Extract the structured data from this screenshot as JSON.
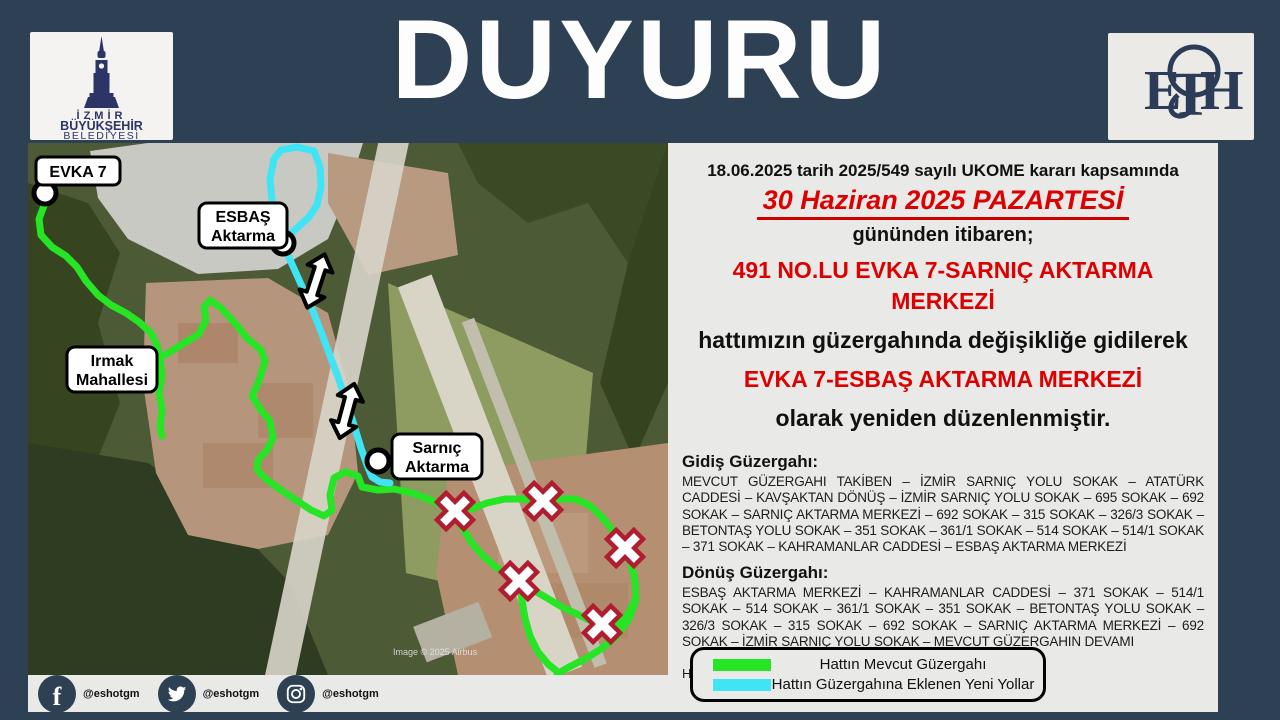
{
  "page": {
    "title": "DUYURU"
  },
  "logos": {
    "izmir": {
      "line1": "İZMİR",
      "line2": "BÜYÜKŞEHİR",
      "line3": "BELEDİYESİ"
    },
    "eshot_letters": [
      "E",
      "T",
      "H"
    ]
  },
  "announcement": {
    "line1": "18.06.2025 tarih 2025/549 sayılı UKOME kararı kapsamında",
    "date_line": "30 Haziran 2025 PAZARTESİ",
    "line3": "gününden itibaren;",
    "route_old": "491 NO.LU EVKA 7-SARNIÇ AKTARMA MERKEZİ",
    "line5": "hattımızın güzergahında değişikliğe gidilerek",
    "route_new": "EVKA 7-ESBAŞ AKTARMA MERKEZİ",
    "line7": "olarak yeniden düzenlenmiştir."
  },
  "gidis": {
    "heading": "Gidiş Güzergahı:",
    "body": "MEVCUT GÜZERGAHI TAKİBEN – İZMİR SARNIÇ YOLU SOKAK – ATATÜRK CADDESİ – KAVŞAKTAN DÖNÜŞ – İZMİR SARNIÇ YOLU SOKAK – 695 SOKAK – 692 SOKAK – SARNIÇ AKTARMA MERKEZİ – 692 SOKAK – 315 SOKAK – 326/3 SOKAK – BETONTAŞ YOLU SOKAK – 351 SOKAK – 361/1 SOKAK – 514 SOKAK – 514/1 SOKAK – 371 SOKAK – KAHRAMANLAR CADDESİ – ESBAŞ AKTARMA MERKEZİ"
  },
  "donus": {
    "heading": "Dönüş Güzergahı:",
    "body": "ESBAŞ AKTARMA MERKEZİ – KAHRAMANLAR CADDESİ – 371 SOKAK – 514/1 SOKAK – 514 SOKAK – 361/1 SOKAK – 351 SOKAK – BETONTAŞ YOLU SOKAK – 326/3 SOKAK – 315 SOKAK – 692 SOKAK – SARNIÇ AKTARMA MERKEZİ – 692 SOKAK – İZMİR SARNIÇ YOLU SOKAK – MEVCUT GÜZERGAHIN DEVAMI"
  },
  "closing": "Hemşehrilerimizin bilgisine sunarız.",
  "legend": {
    "items": [
      {
        "label": "Hattın Mevcut Güzergahı",
        "color": "#25e525"
      },
      {
        "label": "Hattın Güzergahına Eklenen Yeni Yollar",
        "color": "#3fe4f5"
      }
    ]
  },
  "map": {
    "labels": {
      "evka7": "EVKA 7",
      "esbas": [
        "ESBAŞ",
        "Aktarma"
      ],
      "irmak": [
        "Irmak",
        "Mahallesi"
      ],
      "sarnic": [
        "Sarnıç",
        "Aktarma"
      ]
    },
    "copyright": "Image © 2025 Airbus"
  },
  "social": {
    "items": [
      {
        "name": "facebook",
        "handle": "@eshotgm"
      },
      {
        "name": "twitter",
        "handle": "@eshotgm"
      },
      {
        "name": "instagram",
        "handle": "@eshotgm"
      }
    ]
  },
  "colors": {
    "background": "#2e4053",
    "panel": "#e9e9e7",
    "accent_red": "#dd0000",
    "route_current": "#25e525",
    "route_new": "#3fe4f5",
    "x_marker_border": "#b01d30",
    "logo_navy": "#2c3566"
  }
}
